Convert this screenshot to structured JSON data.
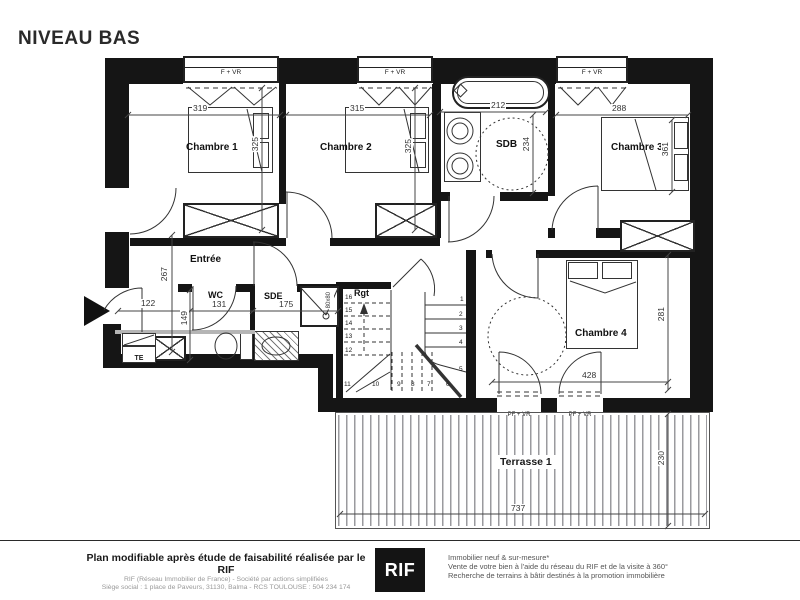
{
  "title": "NIVEAU BAS",
  "colors": {
    "wall": "#151515",
    "line": "#333333",
    "logo_bg": "#141414"
  },
  "windows": {
    "top": [
      "F + VR",
      "F + VR",
      "F + VR"
    ],
    "bottom": [
      "PF + VR",
      "PF + VR"
    ]
  },
  "rooms": {
    "chambre1": {
      "label": "Chambre 1",
      "width": "319",
      "depth": "325"
    },
    "chambre2": {
      "label": "Chambre 2",
      "width": "315",
      "depth": "325"
    },
    "sdb": {
      "label": "SDB",
      "width": "212",
      "depth": "234"
    },
    "chambre3": {
      "label": "Chambre 3",
      "width": "288",
      "depth": "361"
    },
    "entree": {
      "label": "Entrée",
      "depth": "267",
      "entry_width": "122"
    },
    "wc": {
      "label": "WC",
      "width": "131",
      "depth": "149"
    },
    "sde": {
      "label": "SDE",
      "width": "175",
      "shower": "80x80"
    },
    "rgt": {
      "label": "Rgt"
    },
    "chambre4": {
      "label": "Chambre 4",
      "width": "428",
      "depth": "281"
    },
    "terrasse": {
      "label": "Terrasse 1",
      "width": "737",
      "depth": "230"
    },
    "te": {
      "label": "TE"
    }
  },
  "stairs": {
    "left": [
      "16",
      "15",
      "14",
      "13",
      "12"
    ],
    "bottom": [
      "11",
      "10",
      "9",
      "8",
      "7",
      "6"
    ],
    "right": [
      "1",
      "2",
      "3",
      "4",
      "5"
    ]
  },
  "footer": {
    "claim": "Plan modifiable après étude de faisabilité réalisée par le RIF",
    "company_line1": "RIF (Réseau Immobilier de France) - Société par actions simplifiées",
    "company_line2": "Siège social : 1 place de Paveurs, 31130, Balma - RCS TOULOUSE : 504 234 174",
    "logo": "RIF",
    "services": [
      "Immobilier neuf & sur-mesure*",
      "Vente de votre bien à l'aide du réseau du RIF et de la visite à 360°",
      "Recherche de terrains à bâtir destinés à la promotion immobilière"
    ]
  }
}
